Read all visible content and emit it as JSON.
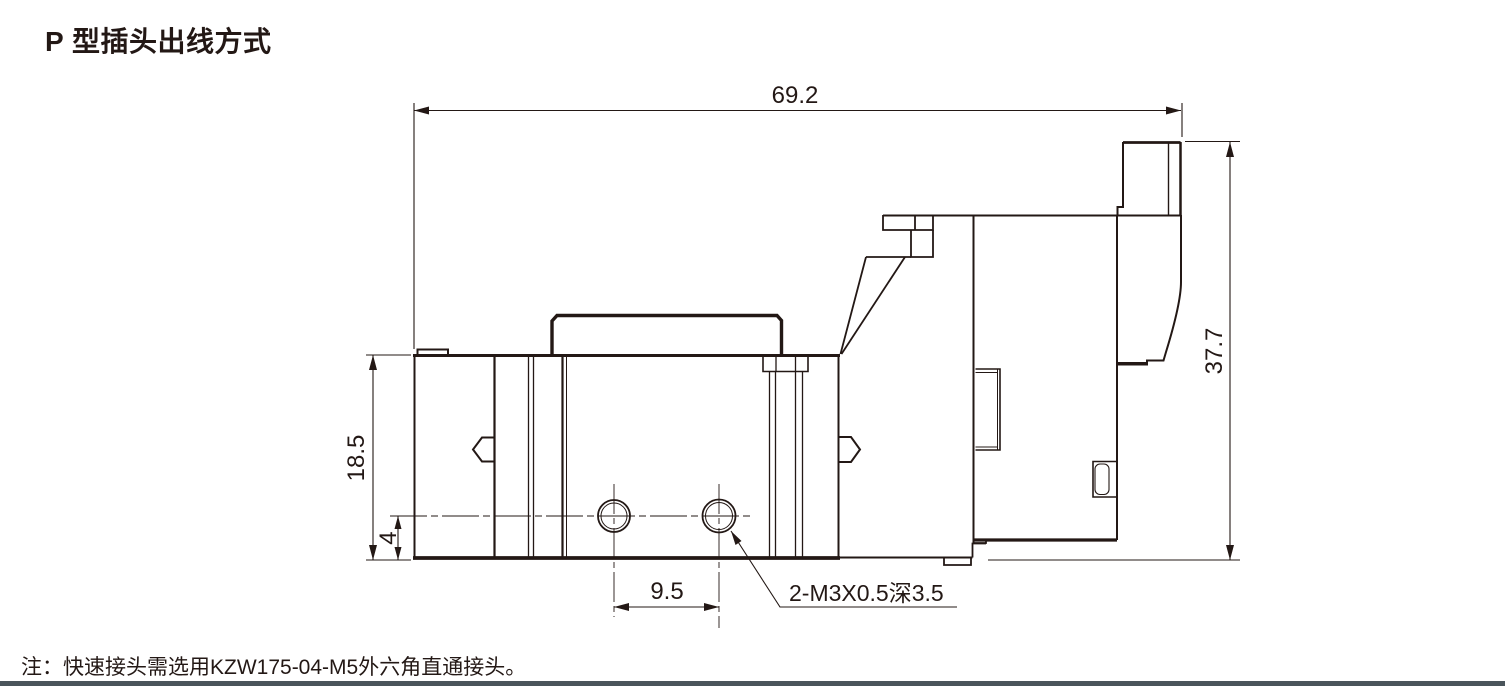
{
  "title": "P 型插头出线方式",
  "note": "注：快速接头需选用KZW175-04-M5外六角直通接头。",
  "drawing": {
    "kind": "valve-side-view-technical-drawing",
    "dimensions": {
      "total_width": "69.2",
      "total_height": "37.7",
      "body_height": "18.5",
      "hole_center_to_bottom": "4",
      "hole_spacing": "9.5",
      "thread_callout": "2-M3X0.5深3.5"
    },
    "colors": {
      "line": "#231815",
      "rule": "#4a555b"
    }
  }
}
